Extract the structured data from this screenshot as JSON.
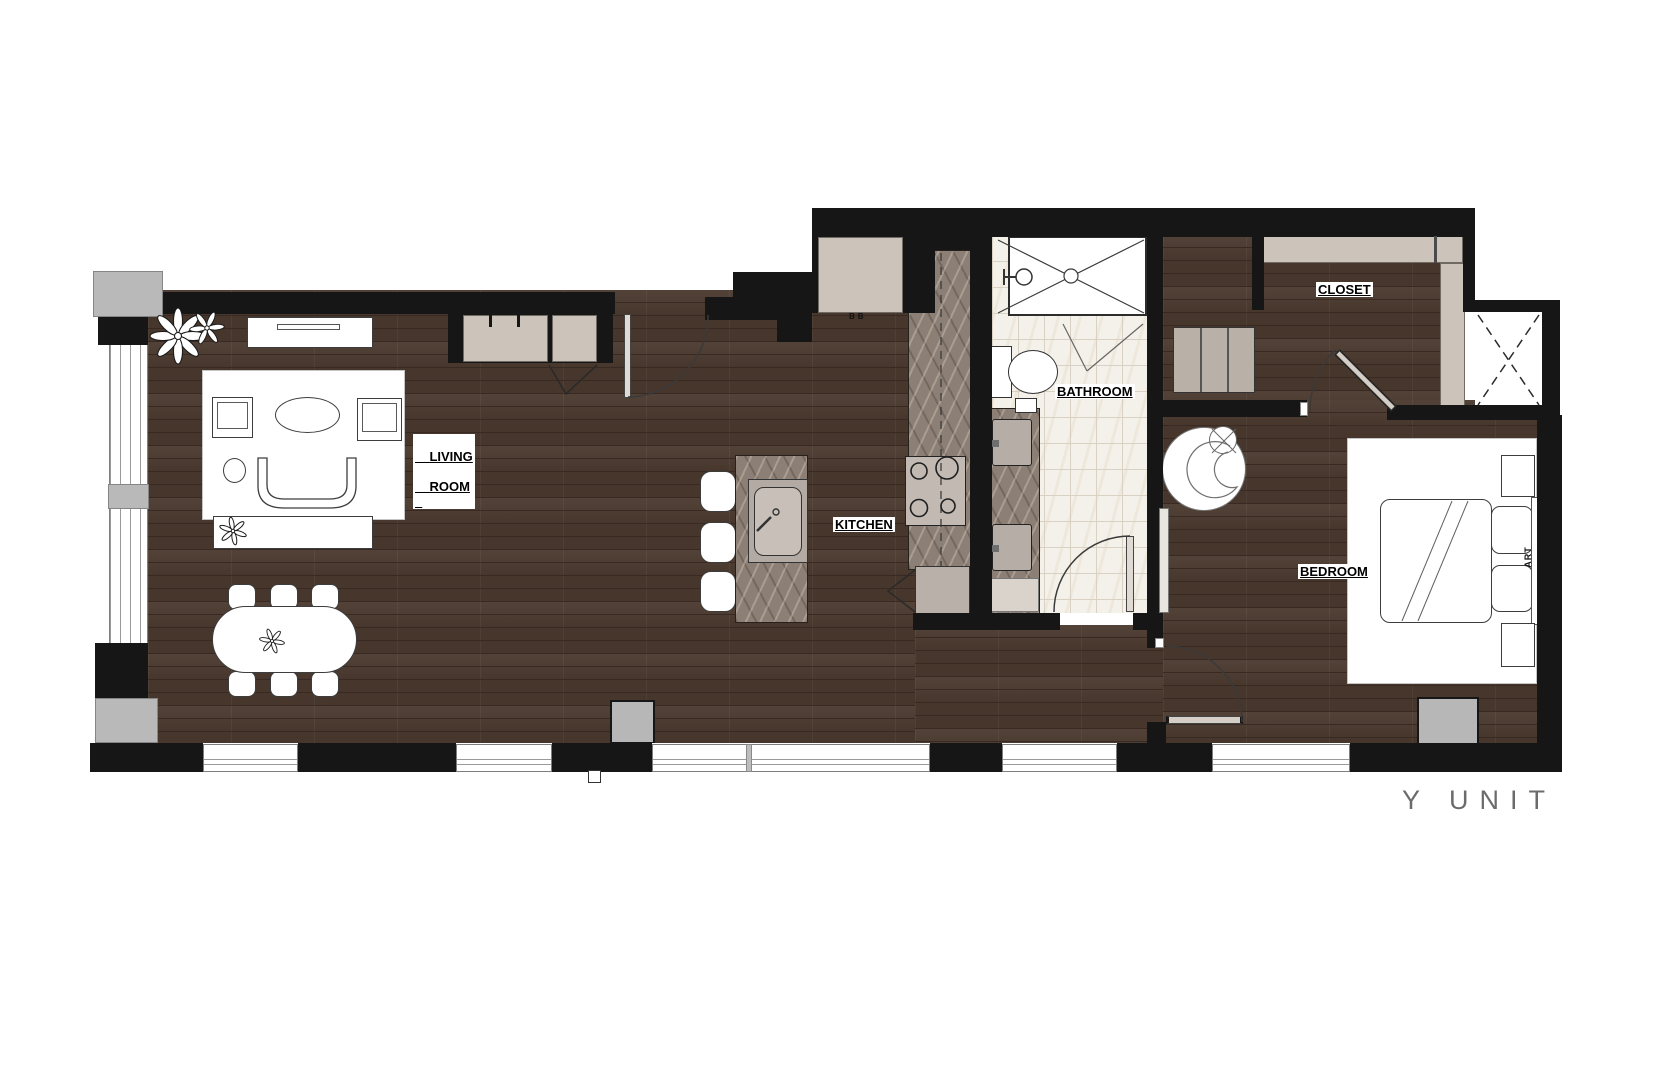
{
  "title": {
    "text": "Y UNIT"
  },
  "rooms": {
    "living": {
      "line1": "LIVING",
      "line2": "ROOM"
    },
    "kitchen": "KITCHEN",
    "bathroom": "BATHROOM",
    "closet": "CLOSET",
    "bedroom": "BEDROOM"
  },
  "annotations": {
    "art": "ART",
    "bb": "BB"
  },
  "symbols": [
    "plant",
    "shower",
    "toilet",
    "vanity-sink",
    "kitchen-sink",
    "cooktop",
    "bar-stool",
    "dining-table",
    "sofa",
    "armchair",
    "bed",
    "nightstand",
    "lounge-chair",
    "dresser",
    "wardrobe",
    "door-swing",
    "elevator-shaft",
    "window",
    "hvac-unit"
  ],
  "palette": {
    "wall": "#161616",
    "wood_base": "#4a392e",
    "wood_stripe": "#382a22",
    "marble_base": "#8c8076",
    "tile_base": "#f4f1ea",
    "tile_line": "#d9d2c4",
    "furn_gray": "#b9b0a7",
    "cabinet_gray": "#ccc4bb",
    "pier_gray": "#b9b9b9",
    "hvac_gray": "#b7b7b7",
    "label_text": "#000000",
    "unit_text": "#6b6b6b"
  }
}
